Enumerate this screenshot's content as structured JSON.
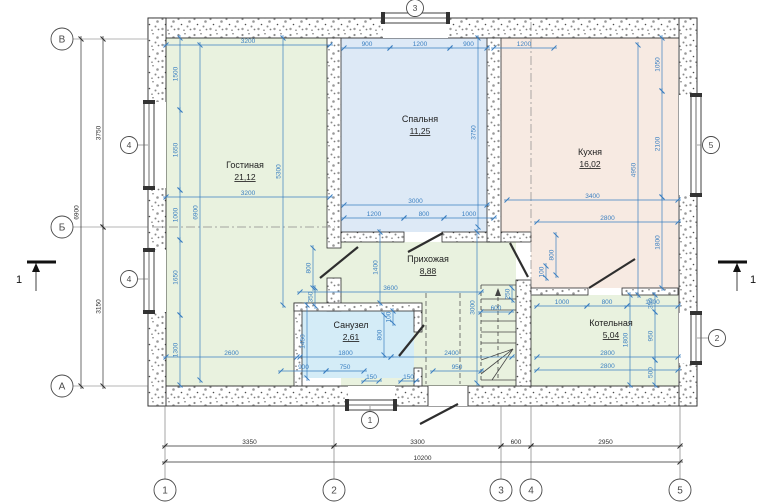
{
  "colors": {
    "dim_blue": "#3a7fc1",
    "line_black": "#2e2e2e",
    "grid_gray": "#4a4a4a",
    "thin_gray": "#6b6b6b",
    "room_green": "#e9f2df",
    "room_blue": "#dde9f6",
    "room_cyan": "#d4ecf7",
    "room_pink": "#f7eae2",
    "label_dark": "#222222"
  },
  "rooms": [
    {
      "id": "living",
      "name": "Гостиная",
      "area": "21,12",
      "label": {
        "x": 245,
        "y": 168
      },
      "color": "room_green",
      "rects": [
        [
          166,
          38,
          161,
          210
        ],
        [
          166,
          248,
          128,
          138
        ],
        [
          294,
          248,
          120,
          55
        ]
      ]
    },
    {
      "id": "bedroom",
      "name": "Спальня",
      "area": "11,25",
      "label": {
        "x": 420,
        "y": 122
      },
      "color": "room_blue",
      "rects": [
        [
          341,
          38,
          146,
          194
        ]
      ]
    },
    {
      "id": "kitchen",
      "name": "Кухня",
      "area": "16,02",
      "label": {
        "x": 590,
        "y": 155
      },
      "color": "room_pink",
      "rects": [
        [
          501,
          38,
          177,
          194
        ],
        [
          531,
          232,
          147,
          56
        ]
      ]
    },
    {
      "id": "hallway",
      "name": "Прихожая",
      "area": "8,88",
      "label": {
        "x": 428,
        "y": 262
      },
      "color": "room_green",
      "rects": [
        [
          341,
          242,
          140,
          144
        ],
        [
          481,
          242,
          35,
          144
        ]
      ]
    },
    {
      "id": "bathroom",
      "name": "Санузел",
      "area": "2,61",
      "label": {
        "x": 351,
        "y": 328
      },
      "color": "room_cyan",
      "rects": [
        [
          302,
          311,
          112,
          67
        ]
      ]
    },
    {
      "id": "boiler",
      "name": "Котельная",
      "area": "5,04",
      "label": {
        "x": 611,
        "y": 326
      },
      "color": "room_green",
      "rects": [
        [
          531,
          295,
          147,
          91
        ]
      ]
    }
  ],
  "walls": {
    "exterior": [
      [
        148,
        18,
        549,
        20
      ],
      [
        148,
        386,
        549,
        20
      ],
      [
        148,
        18,
        18,
        388
      ],
      [
        679,
        18,
        18,
        388
      ]
    ],
    "partitions": [
      [
        327,
        38,
        14,
        210
      ],
      [
        327,
        278,
        14,
        33
      ],
      [
        341,
        232,
        63,
        10
      ],
      [
        442,
        232,
        89,
        10
      ],
      [
        487,
        38,
        14,
        204
      ],
      [
        516,
        280,
        15,
        106
      ],
      [
        294,
        303,
        8,
        83
      ],
      [
        294,
        303,
        128,
        8
      ],
      [
        414,
        311,
        8,
        21
      ],
      [
        414,
        368,
        8,
        18
      ],
      [
        531,
        288,
        57,
        7
      ],
      [
        622,
        288,
        56,
        7
      ]
    ]
  },
  "windows": [
    {
      "id": "window-left-upper",
      "gap": [
        148,
        102,
        18,
        86
      ],
      "frame": [
        144,
        102,
        10,
        86
      ],
      "mark": "4",
      "mark_at": [
        129,
        145
      ]
    },
    {
      "id": "window-left-lower",
      "gap": [
        148,
        250,
        18,
        62
      ],
      "frame": [
        144,
        250,
        10,
        62
      ],
      "mark": "4",
      "mark_at": [
        129,
        279
      ]
    },
    {
      "id": "window-top",
      "gap": [
        383,
        18,
        65,
        20
      ],
      "frame": [
        383,
        13,
        65,
        10
      ],
      "mark": "3",
      "mark_at": [
        415,
        8
      ]
    },
    {
      "id": "window-right-upper",
      "gap": [
        679,
        95,
        18,
        100
      ],
      "frame": [
        691,
        95,
        10,
        100
      ],
      "mark": "5",
      "mark_at": [
        711,
        145
      ]
    },
    {
      "id": "window-right-lower",
      "gap": [
        679,
        313,
        18,
        50
      ],
      "frame": [
        691,
        313,
        10,
        50
      ],
      "mark": "2",
      "mark_at": [
        717,
        338
      ]
    },
    {
      "id": "window-bottom",
      "gap": [
        348,
        386,
        47,
        20
      ],
      "frame": [
        347,
        400,
        48,
        10
      ],
      "mark": "1",
      "mark_at": [
        370,
        420
      ]
    }
  ],
  "entry": {
    "gap": [
      428,
      386,
      40,
      20
    ],
    "door_leaf": [
      420,
      424,
      458,
      404
    ]
  },
  "doors": [
    [
      320,
      278,
      358,
      247
    ],
    [
      408,
      252,
      443,
      233
    ],
    [
      510,
      243,
      528,
      277
    ],
    [
      589,
      288,
      635,
      259
    ],
    [
      399,
      356,
      424,
      325
    ]
  ],
  "stairs": {
    "treads": [
      [
        481,
        285,
        516,
        285
      ],
      [
        481,
        299,
        516,
        299
      ],
      [
        481,
        310,
        516,
        310
      ],
      [
        481,
        321,
        516,
        321
      ],
      [
        481,
        332,
        516,
        332
      ],
      [
        481,
        343,
        516,
        343
      ],
      [
        481,
        380,
        516,
        380
      ]
    ],
    "winders": [
      [
        513,
        349,
        481,
        360
      ],
      [
        513,
        349,
        481,
        374
      ],
      [
        513,
        349,
        492,
        380
      ]
    ],
    "dashed_edge": [
      481,
      285,
      481,
      380
    ],
    "walk_line": [
      498,
      290,
      498,
      378
    ]
  },
  "dashed_lines": [
    [
      426,
      293,
      426,
      384
    ],
    [
      460,
      293,
      460,
      384
    ]
  ],
  "dashdot_lines": [
    [
      152,
      227,
      335,
      227
    ],
    [
      531,
      22,
      531,
      300
    ]
  ],
  "ext_lines": [
    [
      73,
      39,
      148,
      39
    ],
    [
      73,
      227,
      148,
      227
    ],
    [
      73,
      386,
      148,
      386
    ],
    [
      165,
      406,
      165,
      479
    ],
    [
      334,
      406,
      334,
      479
    ],
    [
      501,
      406,
      501,
      479
    ],
    [
      531,
      406,
      531,
      479
    ],
    [
      680,
      406,
      680,
      479
    ],
    [
      138,
      145,
      148,
      145
    ],
    [
      138,
      279,
      148,
      279
    ],
    [
      701,
      145,
      697,
      145
    ],
    [
      709,
      338,
      697,
      338
    ],
    [
      370,
      406,
      370,
      411
    ]
  ],
  "dims_blue": [
    [
      "h",
      166,
      330,
      45,
      "3200"
    ],
    [
      "h",
      344,
      390,
      48,
      "900"
    ],
    [
      "h",
      390,
      450,
      48,
      "1200"
    ],
    [
      "h",
      450,
      487,
      48,
      "900"
    ],
    [
      "h",
      494,
      554,
      48,
      "1200"
    ],
    [
      "h",
      166,
      330,
      197,
      "3200"
    ],
    [
      "h",
      344,
      487,
      205,
      "3000"
    ],
    [
      "h",
      344,
      404,
      218,
      "1200"
    ],
    [
      "h",
      404,
      444,
      218,
      "800"
    ],
    [
      "h",
      444,
      494,
      218,
      "1000"
    ],
    [
      "h",
      507,
      678,
      200,
      "3400"
    ],
    [
      "h",
      537,
      678,
      222,
      "2800"
    ],
    [
      "h",
      300,
      481,
      292,
      "3600"
    ],
    [
      "h",
      481,
      511,
      312,
      "600"
    ],
    [
      "h",
      537,
      587,
      306,
      "1000"
    ],
    [
      "h",
      587,
      627,
      306,
      "800"
    ],
    [
      "h",
      627,
      678,
      306,
      "1000"
    ],
    [
      "h",
      166,
      297,
      357,
      "2600"
    ],
    [
      "h",
      300,
      391,
      357,
      "1800"
    ],
    [
      "h",
      391,
      512,
      357,
      "2400"
    ],
    [
      "h",
      281,
      326,
      371,
      "900"
    ],
    [
      "h",
      326,
      364,
      371,
      "750"
    ],
    [
      "h",
      433,
      481,
      371,
      "950"
    ],
    [
      "h",
      537,
      678,
      357,
      "2800"
    ],
    [
      "h",
      537,
      678,
      370,
      "2800"
    ],
    [
      "h",
      364,
      379,
      381,
      "150"
    ],
    [
      "h",
      401,
      416,
      381,
      "150"
    ],
    [
      "v",
      180,
      38,
      110,
      "1500"
    ],
    [
      "v",
      180,
      110,
      190,
      "1650"
    ],
    [
      "v",
      180,
      190,
      240,
      "1000"
    ],
    [
      "v",
      180,
      240,
      315,
      "1650"
    ],
    [
      "v",
      180,
      315,
      385,
      "1300"
    ],
    [
      "v",
      200,
      45,
      380,
      "6900"
    ],
    [
      "v",
      283,
      38,
      305,
      "5300"
    ],
    [
      "v",
      478,
      38,
      227,
      "3750"
    ],
    [
      "v",
      638,
      45,
      295,
      "4950"
    ],
    [
      "v",
      662,
      38,
      91,
      "1050"
    ],
    [
      "v",
      662,
      91,
      197,
      "2100"
    ],
    [
      "v",
      662,
      197,
      288,
      "1800"
    ],
    [
      "v",
      380,
      232,
      303,
      "1400"
    ],
    [
      "v",
      477,
      232,
      383,
      "3000"
    ],
    [
      "v",
      313,
      248,
      288,
      "800"
    ],
    [
      "v",
      315,
      288,
      306,
      "350"
    ],
    [
      "v",
      307,
      305,
      378,
      "1450"
    ],
    [
      "v",
      384,
      315,
      355,
      "800"
    ],
    [
      "v",
      393,
      311,
      323,
      "100"
    ],
    [
      "v",
      512,
      288,
      300,
      "250"
    ],
    [
      "v",
      556,
      235,
      275,
      "800"
    ],
    [
      "v",
      546,
      266,
      278,
      "100"
    ],
    [
      "v",
      630,
      295,
      385,
      "1800"
    ],
    [
      "v",
      655,
      295,
      312,
      "350"
    ],
    [
      "v",
      655,
      312,
      360,
      "950"
    ],
    [
      "v",
      655,
      360,
      385,
      "500"
    ]
  ],
  "dims_black": [
    [
      "v",
      103,
      39,
      227,
      "3750"
    ],
    [
      "v",
      103,
      227,
      386,
      "3150"
    ],
    [
      "v",
      81,
      39,
      386,
      "6900"
    ],
    [
      "h",
      165,
      334,
      446,
      "3350"
    ],
    [
      "h",
      334,
      501,
      446,
      "3300"
    ],
    [
      "h",
      501,
      531,
      446,
      "600"
    ],
    [
      "h",
      531,
      680,
      446,
      "2950"
    ],
    [
      "h",
      165,
      680,
      462,
      "10200"
    ]
  ],
  "grid": {
    "left": [
      {
        "label": "В",
        "x": 62,
        "y": 39
      },
      {
        "label": "Б",
        "x": 62,
        "y": 227
      },
      {
        "label": "А",
        "x": 62,
        "y": 386
      }
    ],
    "bottom": [
      {
        "label": "1",
        "x": 165,
        "y": 490
      },
      {
        "label": "2",
        "x": 334,
        "y": 490
      },
      {
        "label": "3",
        "x": 501,
        "y": 490
      },
      {
        "label": "4",
        "x": 531,
        "y": 490
      },
      {
        "label": "5",
        "x": 680,
        "y": 490
      }
    ]
  },
  "section_marks": [
    {
      "label": "1",
      "bar": [
        27,
        262,
        56,
        262
      ],
      "stem": [
        36,
        262,
        36,
        291
      ],
      "tri_x": 36,
      "tri_y": 263,
      "label_at": [
        19,
        283
      ]
    },
    {
      "label": "1",
      "bar": [
        718,
        262,
        747,
        262
      ],
      "stem": [
        737,
        262,
        737,
        291
      ],
      "tri_x": 737,
      "tri_y": 263,
      "label_at": [
        753,
        283
      ]
    }
  ]
}
